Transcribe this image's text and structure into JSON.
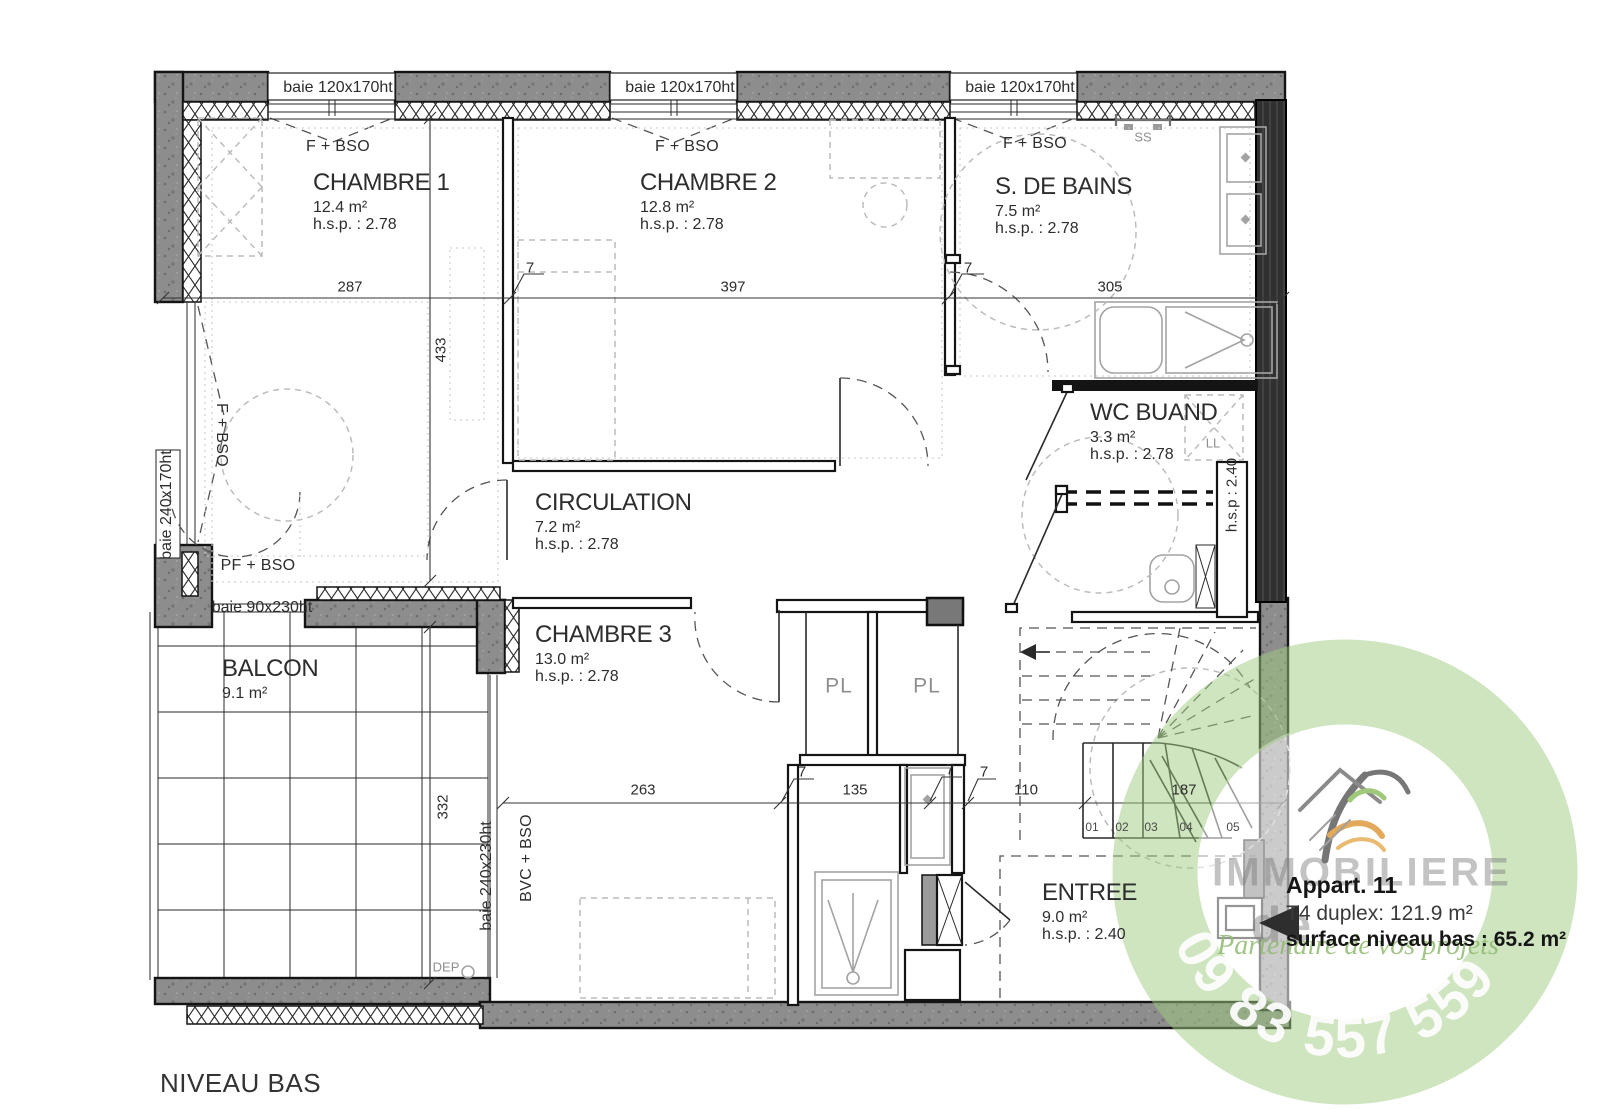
{
  "page": {
    "plan_title": "NIVEAU BAS"
  },
  "rooms": {
    "chambre1": {
      "name": "CHAMBRE 1",
      "area": "12.4 m²",
      "hsp": "h.s.p. : 2.78"
    },
    "chambre2": {
      "name": "CHAMBRE 2",
      "area": "12.8 m²",
      "hsp": "h.s.p. : 2.78"
    },
    "sdb": {
      "name": "S. DE BAINS",
      "area": "7.5 m²",
      "hsp": "h.s.p. : 2.78"
    },
    "wc": {
      "name": "WC BUAND",
      "area": "3.3 m²",
      "hsp": "h.s.p. : 2.78"
    },
    "circulation": {
      "name": "CIRCULATION",
      "area": "7.2 m²",
      "hsp": "h.s.p. : 2.78"
    },
    "chambre3": {
      "name": "CHAMBRE 3",
      "area": "13.0 m²",
      "hsp": "h.s.p. : 2.78"
    },
    "balcon": {
      "name": "BALCON",
      "area": "9.1 m²"
    },
    "entree": {
      "name": "ENTREE",
      "area": "9.0 m²",
      "hsp": "h.s.p. : 2.40"
    }
  },
  "closets": {
    "left": "PL",
    "right": "PL"
  },
  "windows": {
    "top1": "baie 120x170ht",
    "top2": "baie 120x170ht",
    "top3": "baie 120x170ht",
    "left": "baie 240x170ht",
    "balcony_small": "baie 90x230ht",
    "balcony_door": "baie 240x230ht"
  },
  "window_tags": {
    "f_bso_1": "F + BSO",
    "f_bso_2": "F + BSO",
    "f_bso_3": "F + BSO",
    "f_bso_left": "F + BSO",
    "pf_bso": "PF + BSO",
    "bvc_bso": "BVC + BSO"
  },
  "dims": {
    "h287": "287",
    "h397": "397",
    "h305": "305",
    "h263": "263",
    "h135": "135",
    "h110": "110",
    "h187": "187",
    "v433": "433",
    "v332": "332",
    "seven": "7"
  },
  "labels": {
    "ss": "SS",
    "ll": "LL",
    "dep": "DEP",
    "hsp_duct": "h.s.p : 2.40"
  },
  "stairs": {
    "steps": [
      "01",
      "02",
      "03",
      "04",
      "05"
    ]
  },
  "annotation": {
    "title": "Appart. 11",
    "type_line": "T4 duplex: 121.9 m²",
    "surface_line": "surface niveau bas : 65.2 m²"
  },
  "watermark": {
    "brand_top": "IMMOBILIERE",
    "brand_mid": "de",
    "tagline": "Partenaire de vos projets",
    "phone": "09 83 557 559"
  },
  "colors": {
    "wall_gray": "#8d8d8d",
    "party_wall": "#303030",
    "line": "#1c1c1c",
    "furniture": "#bcbcbc",
    "watermark_green": "#9fcb7e"
  }
}
